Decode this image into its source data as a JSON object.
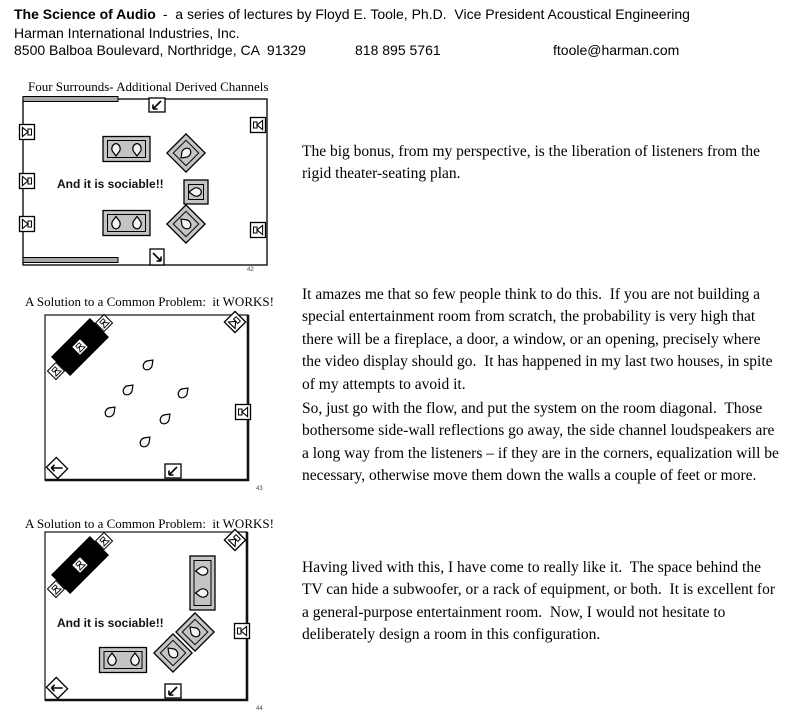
{
  "header": {
    "title": "The Science of Audio",
    "subtitle": "-  a series of lectures by Floyd E. Toole, Ph.D.  Vice President Acoustical Engineering",
    "company": "Harman International Industries, Inc.",
    "address": "8500 Balboa Boulevard, Northridge, CA  91329",
    "phone": "818 895 5761",
    "email": "ftoole@harman.com"
  },
  "figures": [
    {
      "title": "Four Surrounds- Additional Derived Channels",
      "caption": "And it is sociable!!",
      "slide_number": "42",
      "description": "Wide room, three surround speakers on left wall, two on right wall, one top-center and one bottom-center; two sofas and three chairs with listeners"
    },
    {
      "title": "A Solution to a Common Problem:  it WORKS!",
      "slide_number": "43",
      "description": "Square room, TV on diagonal in top-left corner with left/center/right channels, corner and wall surrounds, six listeners on room diagonal"
    },
    {
      "title": "A Solution to a Common Problem:  it WORKS!",
      "caption": "And it is sociable!!",
      "slide_number": "44",
      "description": "Same diagonal TV layout furnished with two sofas and two chairs with listeners"
    }
  ],
  "paragraphs": {
    "p1": "The big bonus, from my perspective, is the liberation of listeners from the rigid theater-seating plan.",
    "p2": "It amazes me that so few people think to do this.  If you are not building a special entertainment room from scratch, the probability is very high that there will be a fireplace, a door, a window, or an opening, precisely where the video display should go.  It has happened in my last two houses, in spite of my attempts to avoid it.",
    "p3": "So, just go with the flow, and put the system on the room diagonal.  Those bothersome side-wall reflections go away, the side channel loudspeakers are a long way from the listeners – if they are in the corners, equalization will be necessary, otherwise move them down the walls a couple of feet or more.",
    "p4": "Having lived with this, I have come to really like it.  The space behind the TV can hide a subwoofer, or a rack of equipment, or both.  It is excellent for a general-purpose entertainment room.  Now, I would not hesitate to deliberately design a room in this configuration."
  },
  "colors": {
    "furniture_gray": "#c4c4c4",
    "wall_black": "#111111",
    "tv_black": "#000000",
    "wall_panel_gray": "#a8a8a8"
  }
}
